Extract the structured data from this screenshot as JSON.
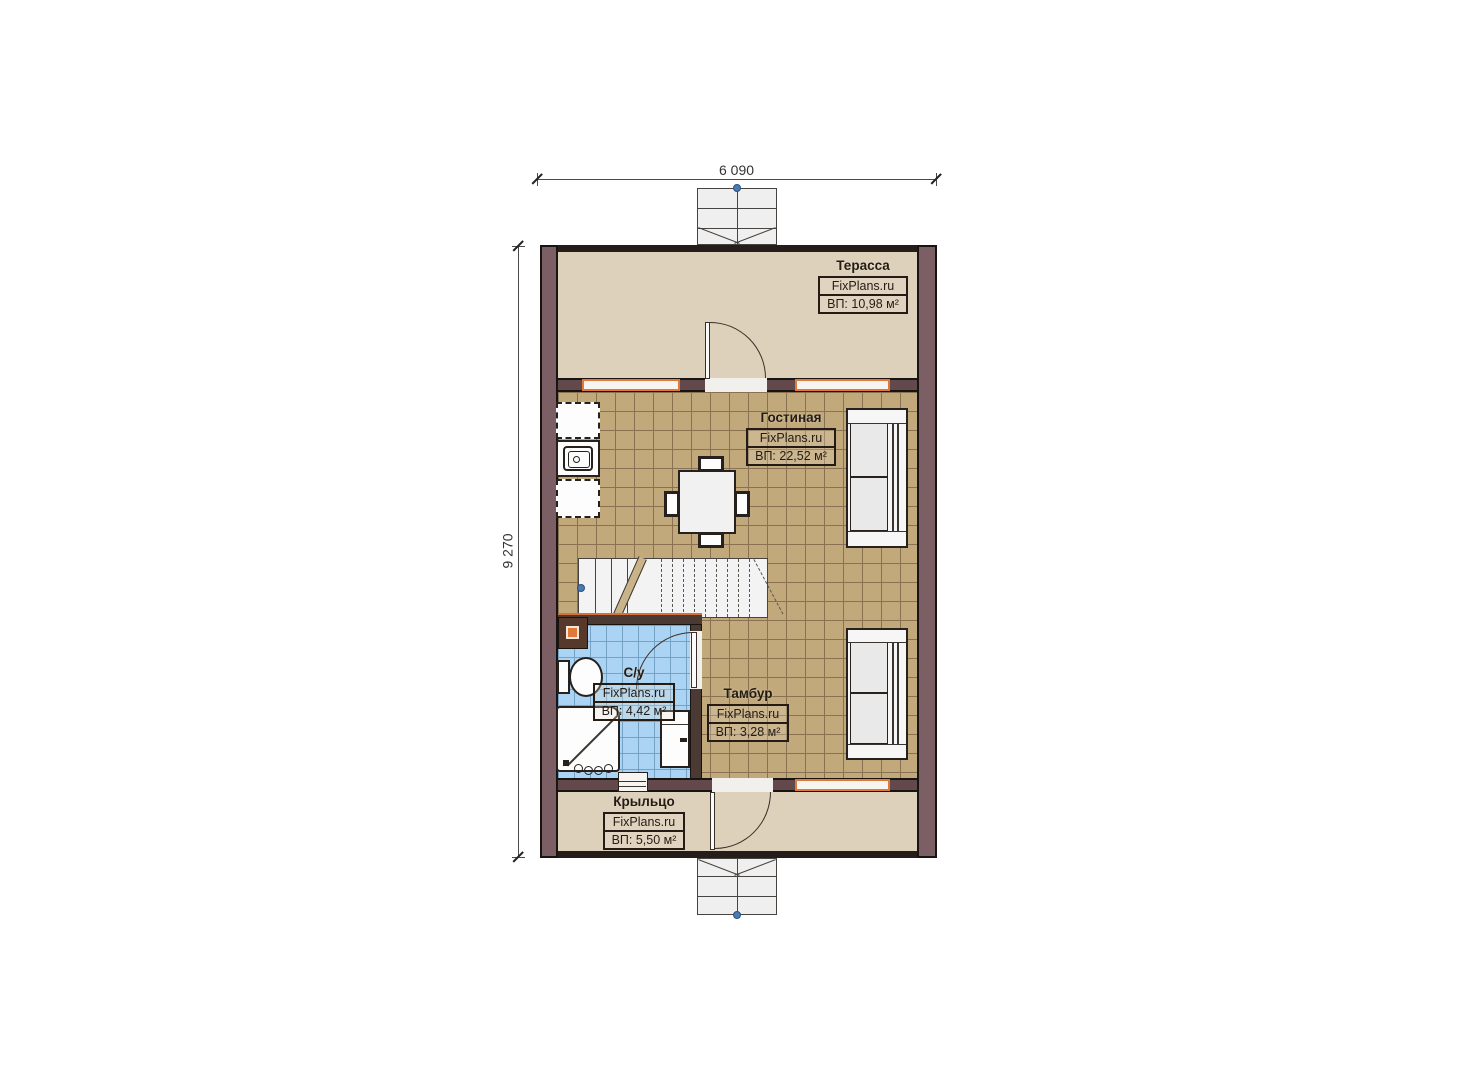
{
  "plan": {
    "watermark": "FixPlans.ru",
    "dimensions": {
      "width": "6 090",
      "height": "9 270"
    },
    "rooms": [
      {
        "name": "Терасса",
        "watermark": "FixPlans.ru",
        "area": "ВП: 10,98 м²"
      },
      {
        "name": "Гостиная",
        "watermark": "FixPlans.ru",
        "area": "ВП: 22,52 м²"
      },
      {
        "name": "С/у",
        "watermark": "FixPlans.ru",
        "area": "ВП: 4,42 м²"
      },
      {
        "name": "Тамбур",
        "watermark": "FixPlans.ru",
        "area": "ВП: 3,28 м²"
      },
      {
        "name": "Крыльцо",
        "watermark": "FixPlans.ru",
        "area": "ВП: 5,50 м²"
      }
    ],
    "colors": {
      "exterior_wall": "#7c5f64",
      "partition_wall": "#63494c",
      "terrace_floor": "#ddd1bc",
      "living_tile": "#c1a97c",
      "bathroom_tile": "#abd4f4",
      "window_frame": "#e0793a",
      "label_border": "#241c14",
      "marker_dot": "#4a7ab5"
    }
  }
}
